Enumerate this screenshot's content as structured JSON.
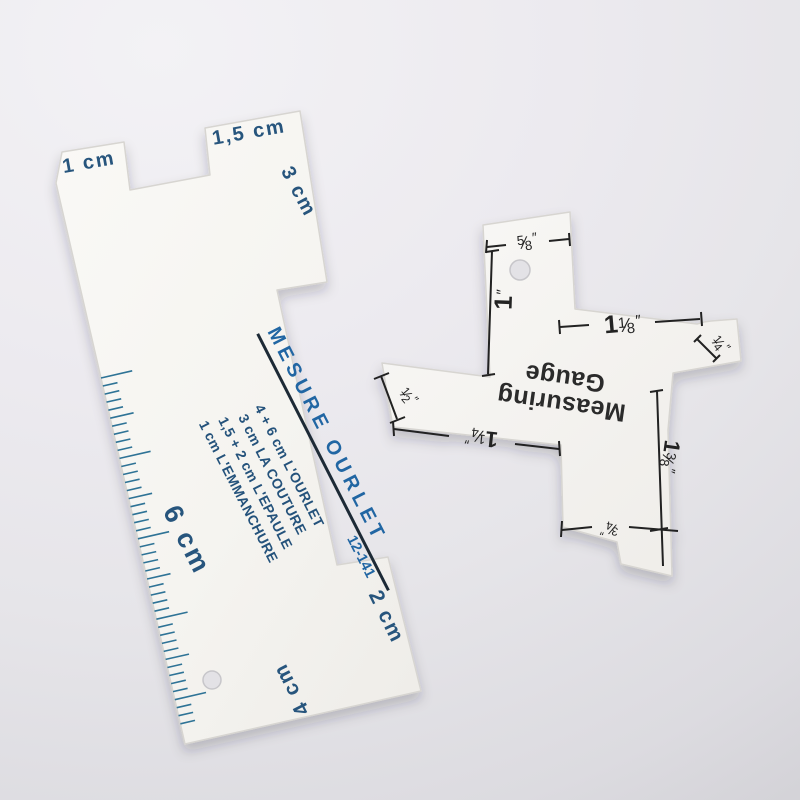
{
  "left_gauge": {
    "ink_primary": "#2166a3",
    "ink_dark": "#24527b",
    "tab1_label": "1 cm",
    "tab2_label": "1,5 cm",
    "side_label": "3 cm",
    "title": "MESURE OURLET",
    "code": "12-141",
    "lines": [
      "4 + 6 cm L'OURLET",
      "3 cm LA COUTURE",
      "1,5 + 2 cm L'EPAULE",
      "1 cm L'EMMANCHURE"
    ],
    "ruler_label": "6 cm",
    "foot_label": "2 cm",
    "bottom_label": "4 cm"
  },
  "right_gauge": {
    "ink": "#232323",
    "title_line1": "Measuring",
    "title_line2": "Gauge",
    "slash": "⁄",
    "unit": "″",
    "m": [
      {
        "name": "five-eighths",
        "num": "5",
        "den": "8"
      },
      {
        "name": "one-inch",
        "whole": "1"
      },
      {
        "name": "one-and-one-eighth",
        "whole": "1",
        "num": "1",
        "den": "8"
      },
      {
        "name": "one-quarter",
        "num": "1",
        "den": "4"
      },
      {
        "name": "one-half",
        "num": "1",
        "den": "2"
      },
      {
        "name": "one-and-one-quarter",
        "whole": "1",
        "num": "1",
        "den": "4"
      },
      {
        "name": "one-and-three-eighths",
        "whole": "1",
        "num": "3",
        "den": "8"
      },
      {
        "name": "three-quarters",
        "num": "3",
        "den": "4"
      }
    ]
  }
}
